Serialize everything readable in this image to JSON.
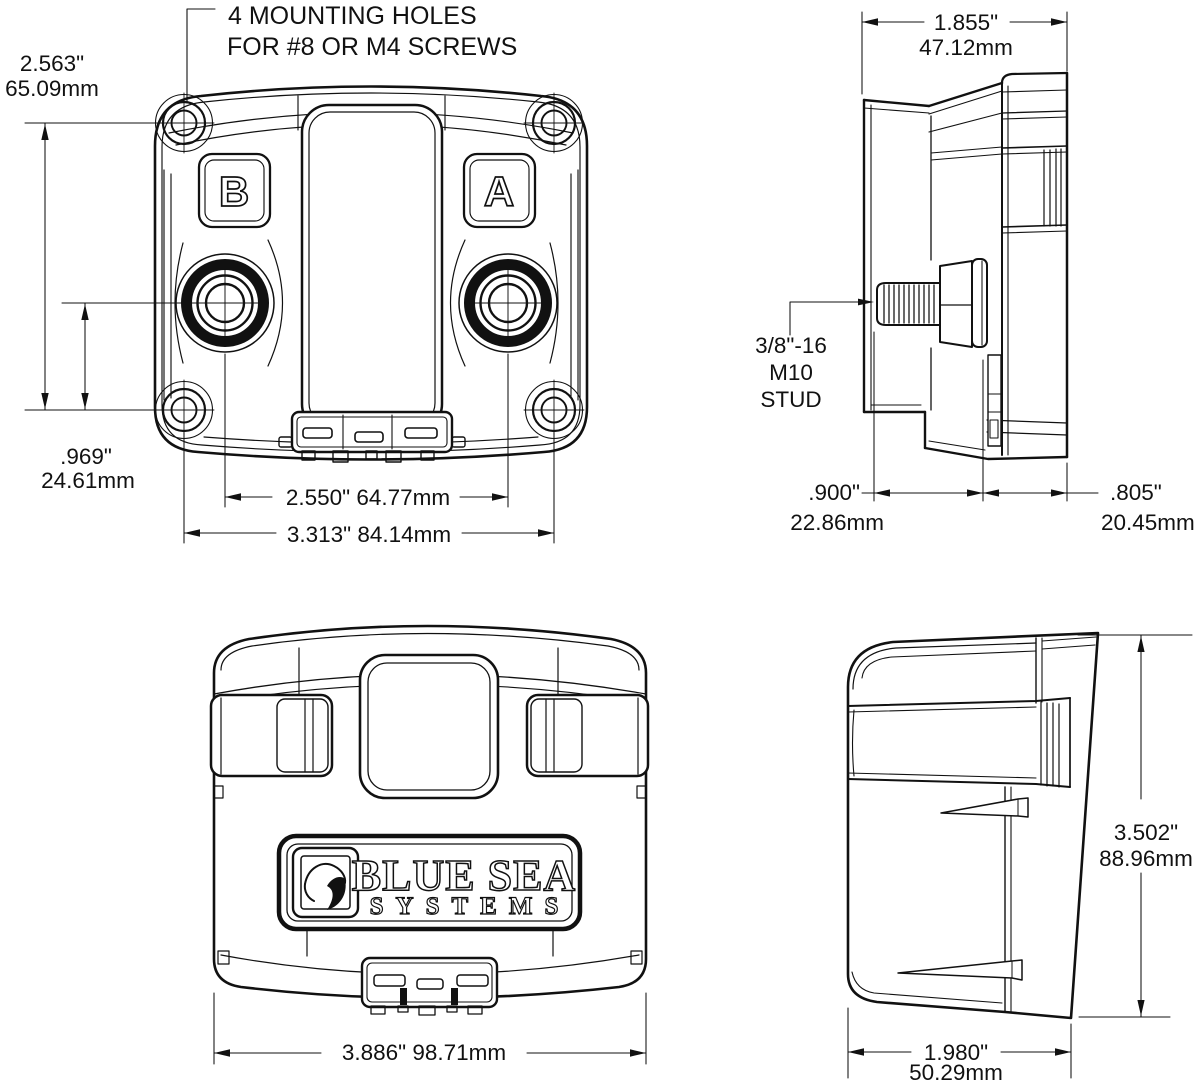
{
  "note": {
    "line1": "4 MOUNTING HOLES",
    "line2": "FOR #8 OR M4 SCREWS"
  },
  "front_view": {
    "button_b": "B",
    "button_a": "A",
    "dim_mount_height": {
      "inches": "2.563\"",
      "mm": "65.09mm"
    },
    "dim_stud_offset": {
      "inches": ".969\"",
      "mm": "24.61mm"
    },
    "dim_stud_spacing": "2.550\" 64.77mm",
    "dim_mount_width": "3.313\" 84.14mm"
  },
  "side_view_top": {
    "dim_overall_depth": {
      "inches": "1.855\"",
      "mm": "47.12mm"
    },
    "stud_callout": {
      "line1": "3/8\"-16",
      "line2": "M10",
      "line3": "STUD"
    },
    "dim_stud_length": {
      "inches": ".900\"",
      "mm": "22.86mm"
    },
    "dim_rear_depth": {
      "inches": ".805\"",
      "mm": "20.45mm"
    }
  },
  "bottom_view": {
    "brand": {
      "line1": "BLUE SEA",
      "line2": "SYSTEMS"
    },
    "dim_overall_width": "3.886\" 98.71mm"
  },
  "side_view_bottom": {
    "dim_overall_height": {
      "inches": "3.502\"",
      "mm": "88.96mm"
    },
    "dim_base_depth": {
      "inches": "1.980\"",
      "mm": "50.29mm"
    }
  }
}
